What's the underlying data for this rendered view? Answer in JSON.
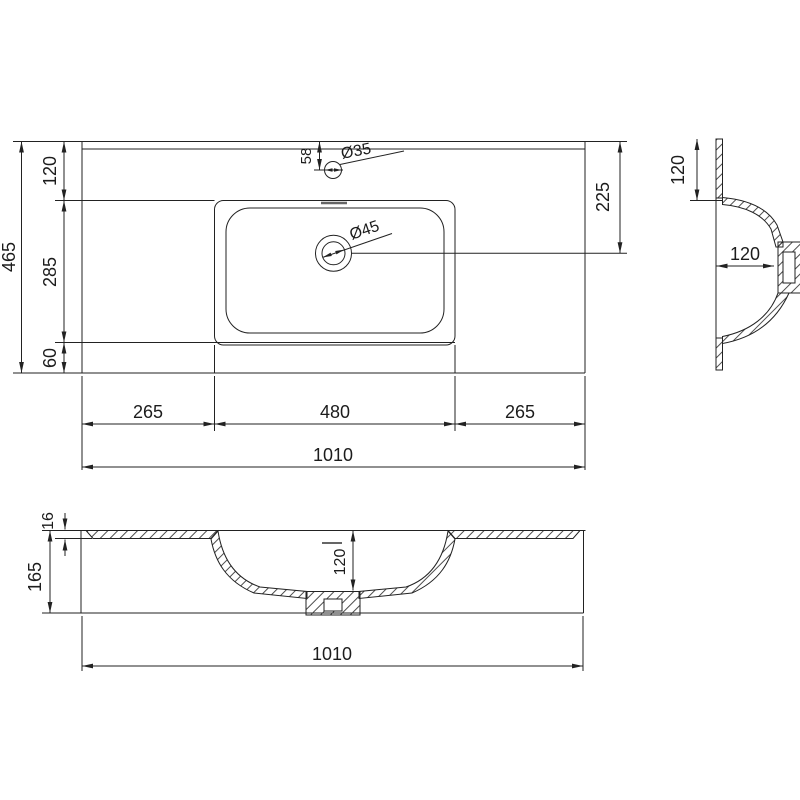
{
  "drawing_type": "washbasin technical dimension drawing",
  "units": "mm",
  "top_view": {
    "overall_width": "1010",
    "overall_depth": "465",
    "depth_segments": [
      "120",
      "285",
      "60"
    ],
    "bottom_segments": [
      "265",
      "480",
      "265"
    ],
    "faucet_offset": "58",
    "faucet_hole_diameter": "Ø35",
    "drain_hole_diameter": "Ø45",
    "drain_center_offset": "225"
  },
  "side_section": {
    "rim_height": "120",
    "bowl_depth": "120"
  },
  "front_section": {
    "countertop_thickness": "16",
    "overall_height": "165",
    "bowl_depth": "120",
    "overall_width": "1010"
  },
  "colors": {
    "line": "#222222",
    "hatch": "#3a3a3a",
    "background": "#ffffff",
    "slot_mark": "#666666"
  }
}
